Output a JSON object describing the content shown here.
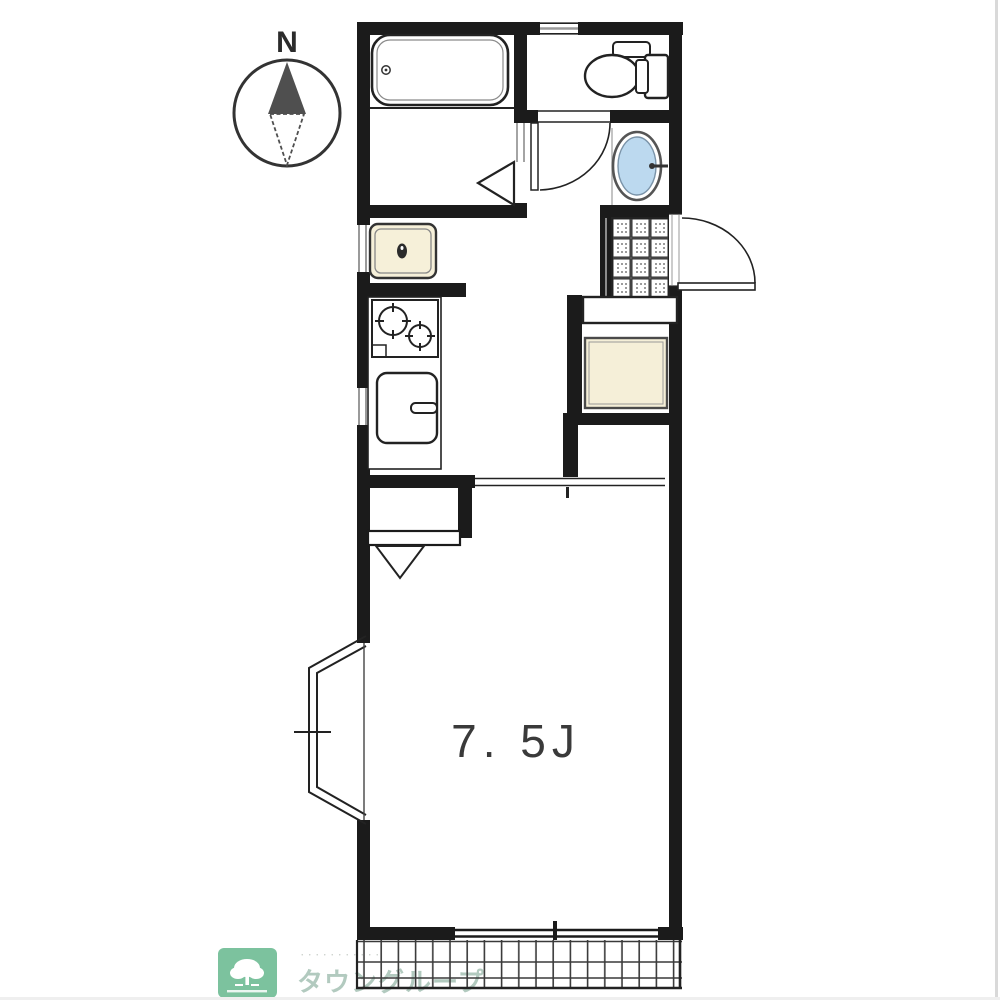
{
  "plan": {
    "compass_label": "N",
    "room_label": "7. 5J",
    "room_label_color": "#3a3a3a"
  },
  "logo": {
    "brand": "タウングループ",
    "tagline": "･･･････････",
    "box_color": "#7cc29e",
    "text_color": "#b2cabf"
  },
  "colors": {
    "wall": "#1b1b1b",
    "fixture_outline": "#222222",
    "washbasin_fill": "#bcd9ef",
    "washing_machine_pan_fill": "#f6f0d9",
    "storage_fill": "#f5efd8",
    "window_gray": "#9a9a9a"
  },
  "fixtures": [
    "compass-north",
    "bathtub",
    "bathroom-folding-door",
    "toilet",
    "toilet-door",
    "washbasin",
    "entrance-tile",
    "entrance-door",
    "entrance-step",
    "storage-box",
    "washing-machine-pan",
    "gas-stove",
    "kitchen-sink",
    "room-folding-door",
    "sliding-door-track",
    "bay-window",
    "south-window",
    "balcony"
  ]
}
